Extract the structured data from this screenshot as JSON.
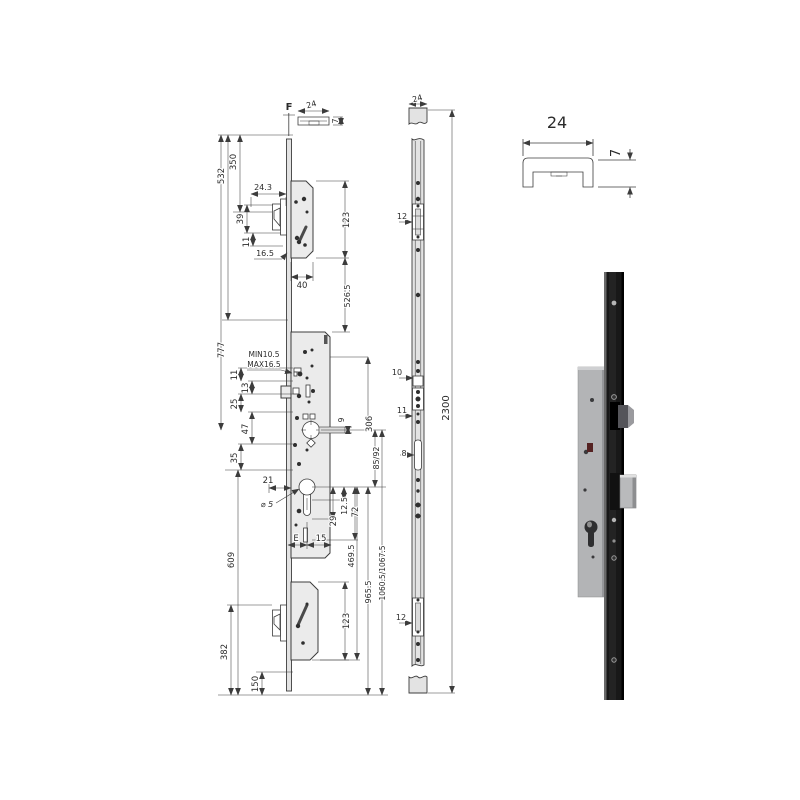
{
  "colors": {
    "background": "#ffffff",
    "drawing_line": "#3c3c3c",
    "part_fill": "#ebebeb",
    "photo_strip": "#181818",
    "photo_case": "#b3b4b6",
    "bolt_silver": "#b9babc"
  },
  "drawing": {
    "left_view": [
      {
        "id": "f-ref",
        "t": "F",
        "x": 289,
        "y": 110,
        "r": 0,
        "s": 10,
        "b": true
      },
      {
        "id": "profile-24",
        "t": "24",
        "x": 312,
        "y": 107,
        "r": -15,
        "s": 8
      },
      {
        "id": "profile-7",
        "t": "7",
        "x": 338,
        "y": 121,
        "r": -90,
        "s": 8
      },
      {
        "id": "dim-350",
        "t": "350",
        "x": 236,
        "y": 162,
        "r": -90,
        "s": 8.5
      },
      {
        "id": "dim-532",
        "t": "532",
        "x": 224,
        "y": 176,
        "r": -90,
        "s": 8.5
      },
      {
        "id": "dim-777",
        "t": "777",
        "x": 224,
        "y": 350,
        "r": -90,
        "s": 8.5
      },
      {
        "id": "dim-609",
        "t": "609",
        "x": 234,
        "y": 560,
        "r": -90,
        "s": 8.5
      },
      {
        "id": "dim-382",
        "t": "382",
        "x": 227,
        "y": 652,
        "r": -90,
        "s": 8.5
      },
      {
        "id": "dim-150",
        "t": "150",
        "x": 258,
        "y": 684,
        "r": -90,
        "s": 8.5
      },
      {
        "id": "dim-24.3",
        "t": "24.3",
        "x": 263,
        "y": 190,
        "r": 0,
        "s": 8
      },
      {
        "id": "dim-39",
        "t": "39",
        "x": 243,
        "y": 219,
        "r": -90,
        "s": 8.5
      },
      {
        "id": "dim-11-top",
        "t": "11",
        "x": 249,
        "y": 242,
        "r": -90,
        "s": 8.5
      },
      {
        "id": "dim-16.5",
        "t": "16.5",
        "x": 265,
        "y": 256,
        "r": 0,
        "s": 8
      },
      {
        "id": "dim-40",
        "t": "40",
        "x": 302,
        "y": 288,
        "r": 0,
        "s": 8.5
      },
      {
        "id": "dim-123-top",
        "t": "123",
        "x": 349,
        "y": 220,
        "r": -90,
        "s": 8.5
      },
      {
        "id": "dim-526.5",
        "t": "526.5",
        "x": 350,
        "y": 296,
        "r": -90,
        "s": 8
      },
      {
        "id": "note-min",
        "t": "MIN10.5",
        "x": 264,
        "y": 357,
        "r": 0,
        "s": 7.5
      },
      {
        "id": "note-max",
        "t": "MAX16.5",
        "x": 264,
        "y": 367,
        "r": 0,
        "s": 7.5
      },
      {
        "id": "dim-11-mid",
        "t": "11",
        "x": 237,
        "y": 375,
        "r": -90,
        "s": 8.5
      },
      {
        "id": "dim-13",
        "t": "13",
        "x": 248,
        "y": 388,
        "r": -90,
        "s": 8.5
      },
      {
        "id": "dim-25",
        "t": "25",
        "x": 237,
        "y": 404,
        "r": -90,
        "s": 8.5
      },
      {
        "id": "dim-47",
        "t": "47",
        "x": 248,
        "y": 429,
        "r": -90,
        "s": 8.5
      },
      {
        "id": "dim-35",
        "t": "35",
        "x": 237,
        "y": 458,
        "r": -90,
        "s": 8.5
      },
      {
        "id": "dim-21",
        "t": "21",
        "x": 268,
        "y": 483,
        "r": 0,
        "s": 8.5
      },
      {
        "id": "dim-dia5",
        "t": "⌀ 5",
        "x": 267,
        "y": 507,
        "r": 0,
        "s": 8,
        "i": true
      },
      {
        "id": "dim-9",
        "t": "9",
        "x": 344,
        "y": 420,
        "r": -90,
        "s": 7.5
      },
      {
        "id": "dim-306",
        "t": "306",
        "x": 372,
        "y": 424,
        "r": -90,
        "s": 8.5
      },
      {
        "id": "dim-85-92",
        "t": "85/92",
        "x": 379,
        "y": 458,
        "r": -90,
        "s": 8
      },
      {
        "id": "dim-12.5",
        "t": "12.5",
        "x": 347,
        "y": 506,
        "r": -90,
        "s": 8
      },
      {
        "id": "dim-72",
        "t": "72",
        "x": 358,
        "y": 512,
        "r": -90,
        "s": 8.5
      },
      {
        "id": "dim-29",
        "t": "29",
        "x": 336,
        "y": 521,
        "r": -90,
        "s": 8.5
      },
      {
        "id": "dim-E",
        "t": "E",
        "x": 296,
        "y": 541,
        "r": 0,
        "s": 8.5
      },
      {
        "id": "dim-15",
        "t": "15",
        "x": 321,
        "y": 541,
        "r": 0,
        "s": 8.5
      },
      {
        "id": "dim-469.5",
        "t": "469.5",
        "x": 354,
        "y": 556,
        "r": -90,
        "s": 8
      },
      {
        "id": "dim-965.5",
        "t": "965.5",
        "x": 371,
        "y": 592,
        "r": -90,
        "s": 8
      },
      {
        "id": "dim-1060.5",
        "t": "1060.5/1067.5",
        "x": 385,
        "y": 573,
        "r": -90,
        "s": 7.5
      },
      {
        "id": "dim-123-bottom",
        "t": "123",
        "x": 349,
        "y": 621,
        "r": -90,
        "s": 8.5
      }
    ],
    "faceplate_view": [
      {
        "id": "fp-24",
        "t": "24",
        "x": 418,
        "y": 101,
        "r": -15,
        "s": 8
      },
      {
        "id": "fp-12-top",
        "t": "12",
        "x": 402,
        "y": 219,
        "r": 0,
        "s": 8
      },
      {
        "id": "fp-10",
        "t": "10",
        "x": 397,
        "y": 375,
        "r": 0,
        "s": 8
      },
      {
        "id": "fp-11",
        "t": "11",
        "x": 402,
        "y": 413,
        "r": 0,
        "s": 8
      },
      {
        "id": "fp-8",
        "t": "8",
        "x": 404,
        "y": 456,
        "r": 0,
        "s": 8
      },
      {
        "id": "fp-12-bottom",
        "t": "12",
        "x": 401,
        "y": 620,
        "r": 0,
        "s": 8
      },
      {
        "id": "fp-2300",
        "t": "2300",
        "x": 449,
        "y": 408,
        "r": -90,
        "s": 10
      }
    ],
    "profile_detail": [
      {
        "id": "pf-24",
        "t": "24",
        "x": 557,
        "y": 128,
        "r": 0,
        "s": 16
      },
      {
        "id": "pf-7",
        "t": "7",
        "x": 620,
        "y": 153,
        "r": -90,
        "s": 13
      }
    ]
  }
}
